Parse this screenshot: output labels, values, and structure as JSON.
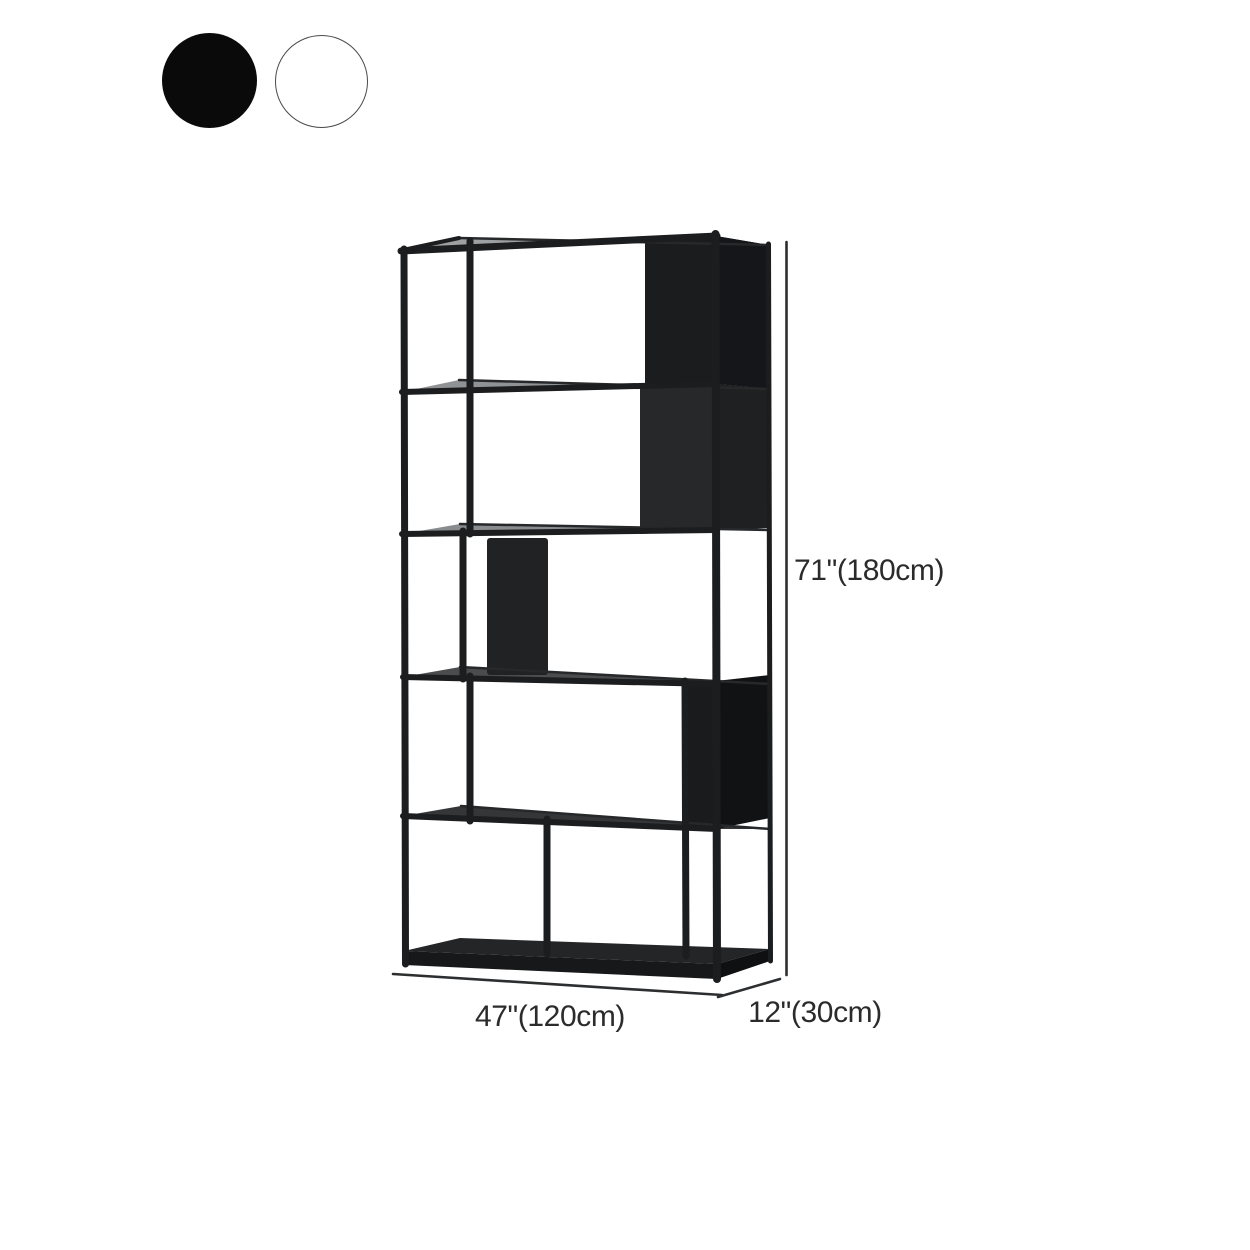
{
  "figure": {
    "name": "bookshelf-dimension-diagram",
    "description": "Black metal geometric etagere bookshelf shown in perspective with overall dimensions",
    "height_label": "71\"(180cm)",
    "width_label": "47\"(120cm)",
    "depth_label": "12\"(30cm)"
  },
  "color_options": {
    "selected": "Black",
    "options": [
      {
        "name": "Black",
        "hex": "#0a0a0a"
      },
      {
        "name": "White",
        "hex": "#ffffff"
      }
    ]
  },
  "palette": {
    "frame": "#1b1d1f",
    "panel_front": "#232527",
    "panel_side": "#141619",
    "shelf_top_highlight": "#9ea1a3",
    "dimension_line": "#2c2e30",
    "dimension_text": "#2b2b2b",
    "background": "#ffffff"
  }
}
